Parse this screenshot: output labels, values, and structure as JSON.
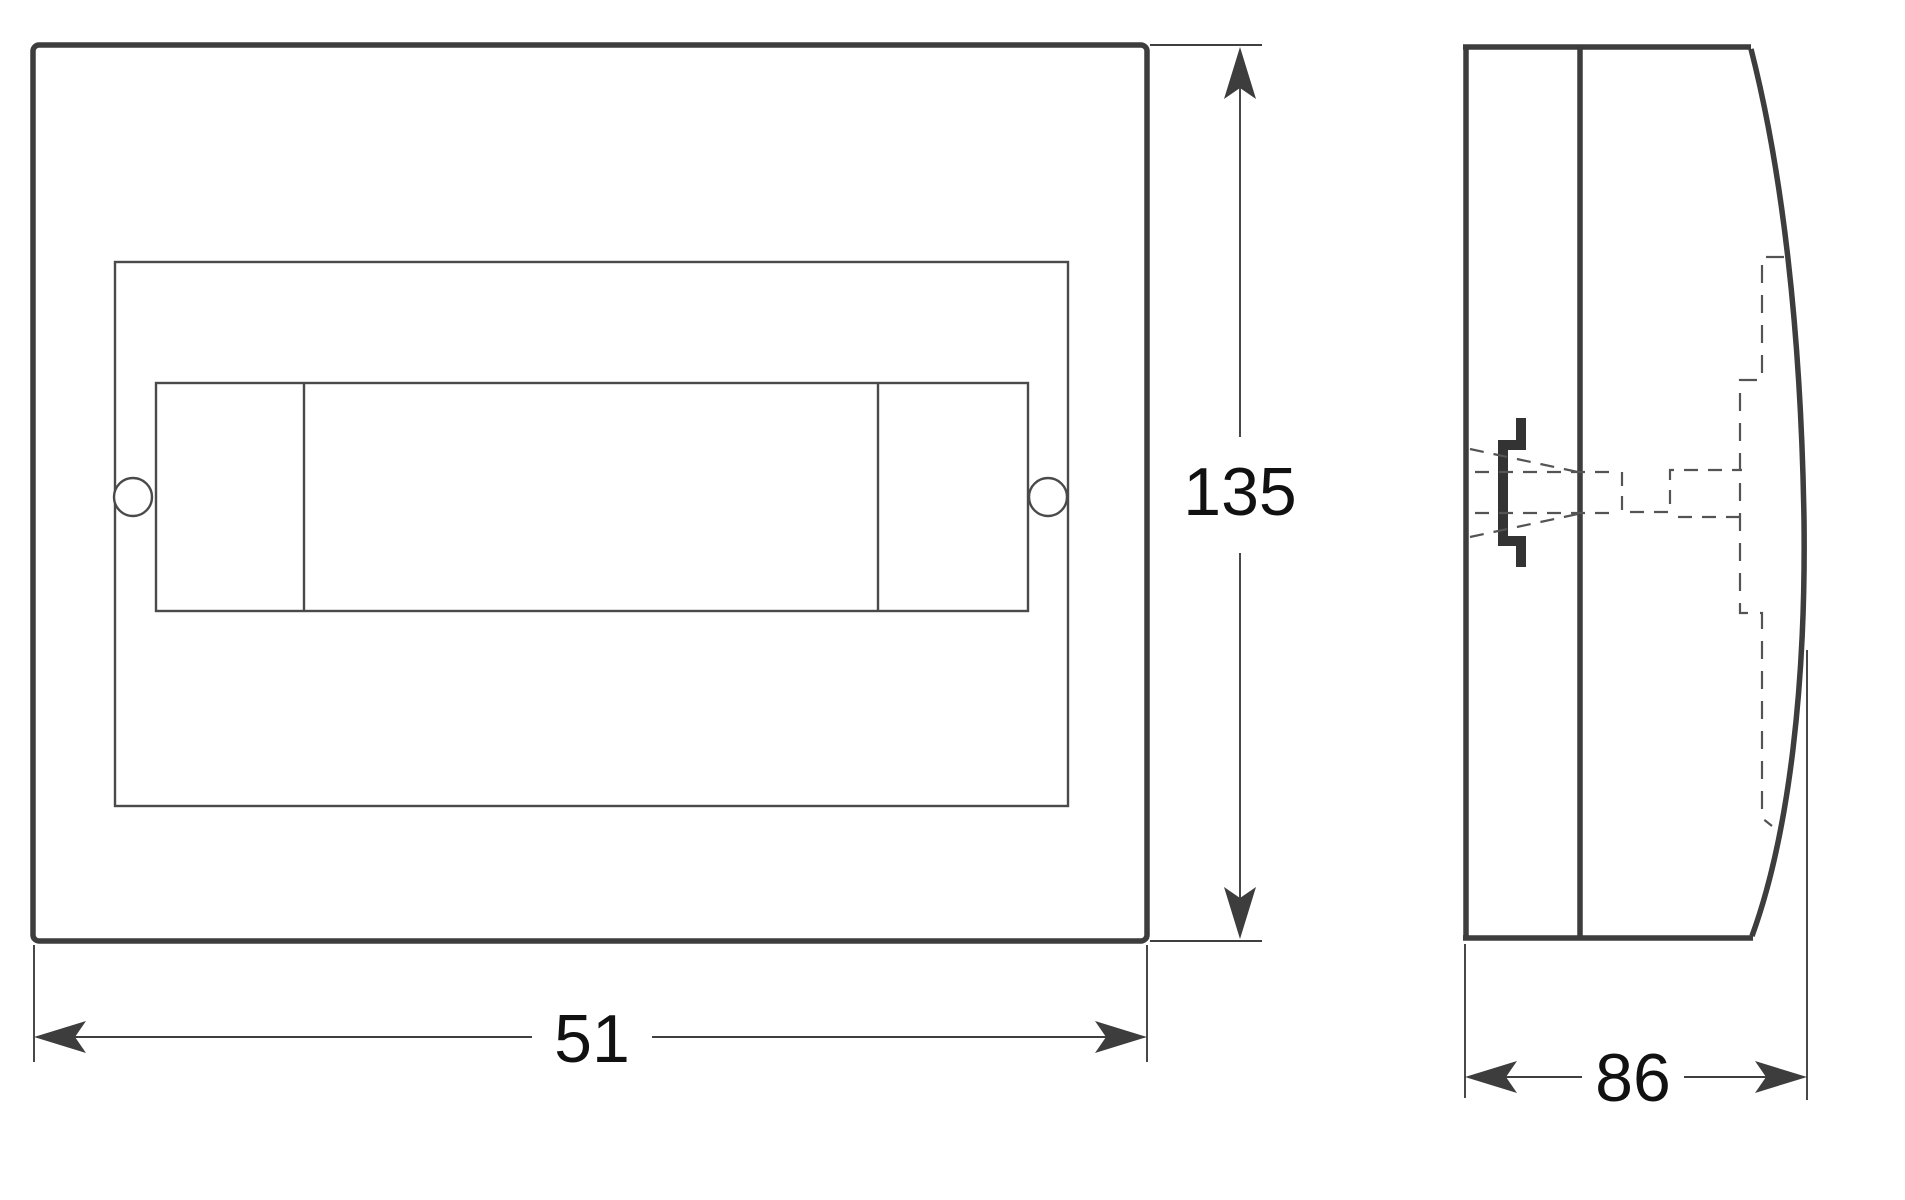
{
  "drawing": {
    "colors": {
      "thick_line": "#3d3d3d",
      "thin_line": "#4a4a4a",
      "dashed_line": "#545454",
      "text": "#111111",
      "background": "#ffffff"
    },
    "front_view": {
      "width_label": "51",
      "height_label": "135"
    },
    "side_view": {
      "depth_label": "86"
    }
  }
}
